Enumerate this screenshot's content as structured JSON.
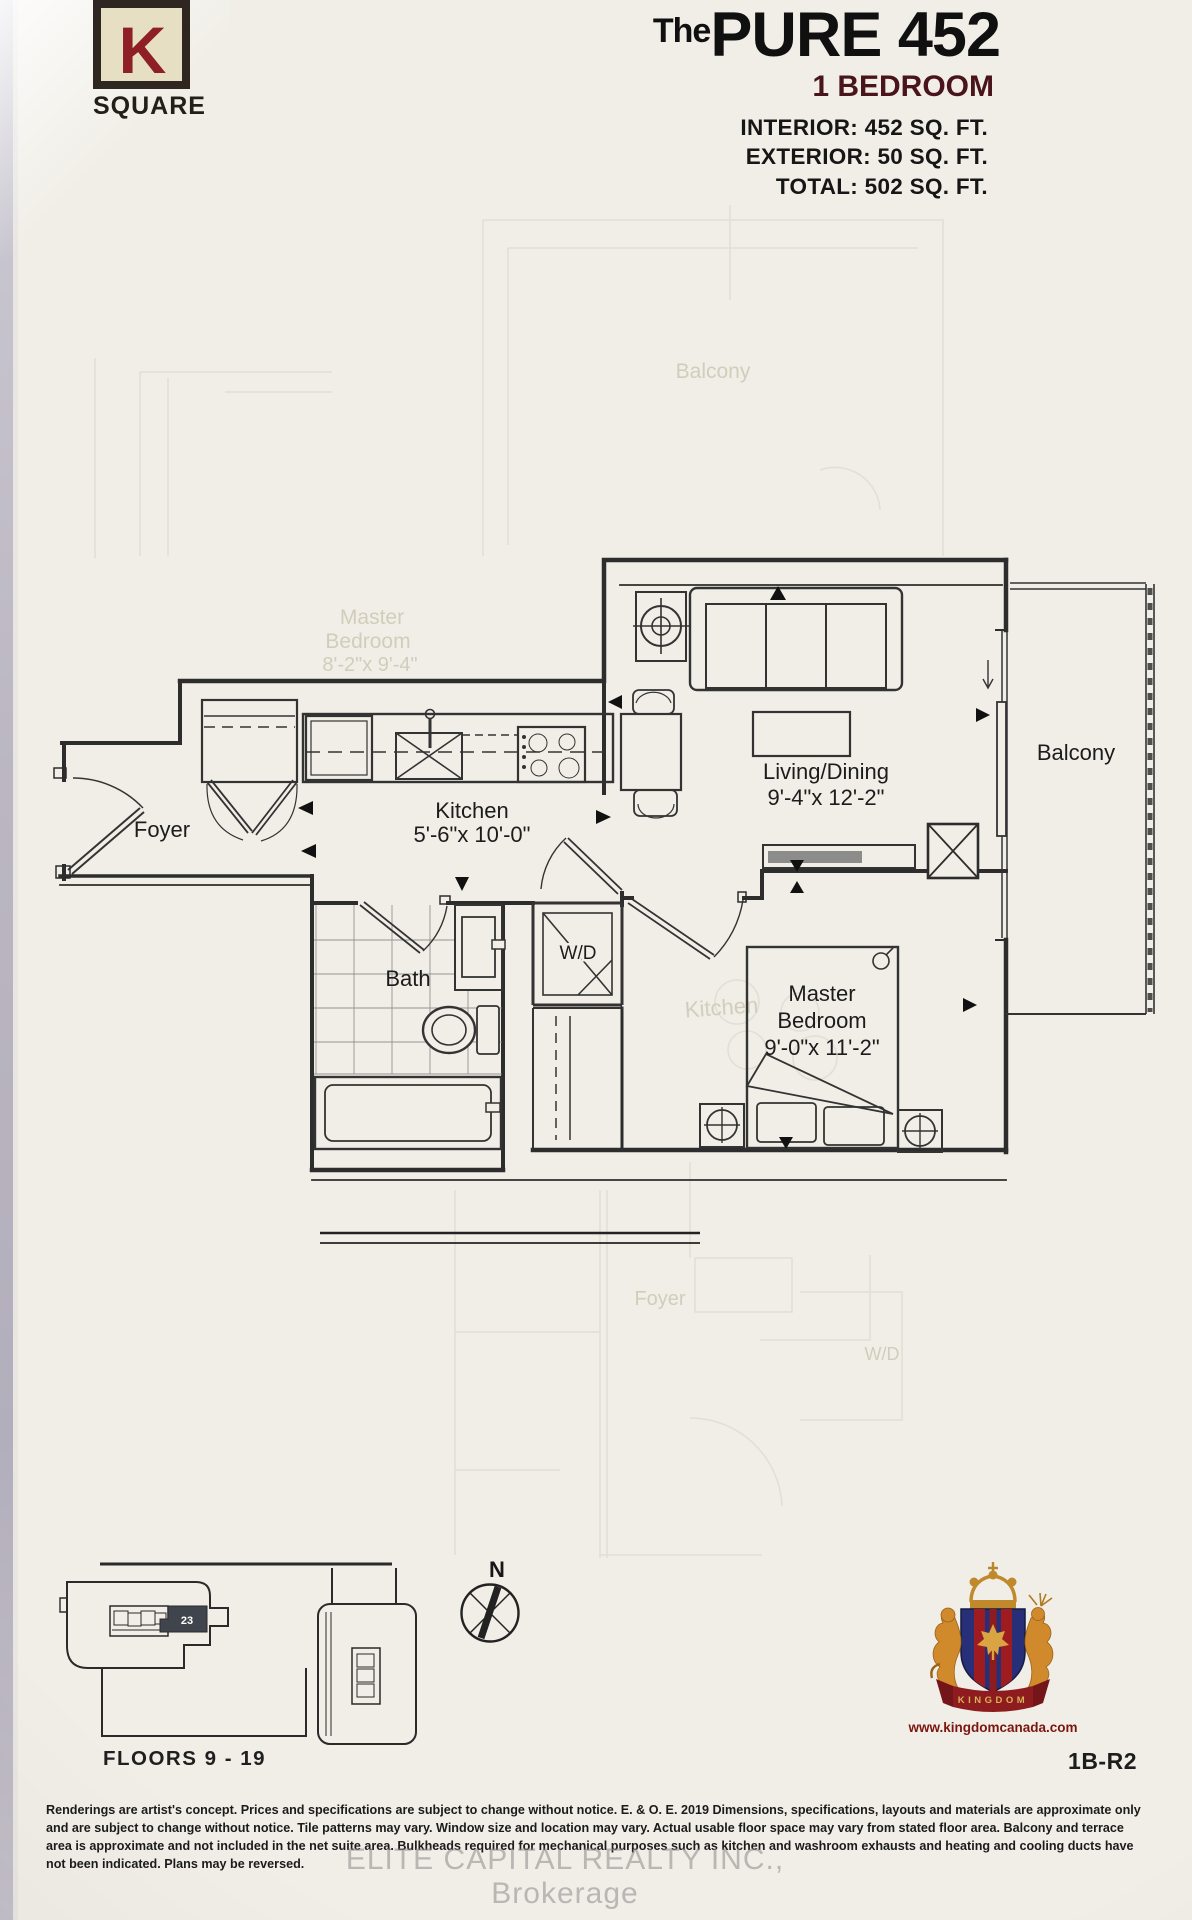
{
  "branding": {
    "logo_letter": "K",
    "logo_word": "SQUARE"
  },
  "header": {
    "title_prefix": "The",
    "title_main": "PURE 452",
    "plan_type": "1 BEDROOM",
    "area_lines": [
      "INTERIOR: 452 SQ. FT.",
      "EXTERIOR: 50 SQ. FT.",
      "TOTAL: 502 SQ. FT."
    ]
  },
  "floorplan": {
    "rooms": [
      {
        "name": "Foyer",
        "dims": ""
      },
      {
        "name": "Kitchen",
        "dims": "5'-6\"x 10'-0\""
      },
      {
        "name": "Living/Dining",
        "dims": "9'-4\"x 12'-2\""
      },
      {
        "name": "Balcony",
        "dims": ""
      },
      {
        "name": "Bath",
        "dims": ""
      },
      {
        "name": "W/D",
        "dims": ""
      },
      {
        "name": "Master",
        "name2": "Bedroom",
        "dims": "9'-0\"x 11'-2\""
      }
    ],
    "ghost_labels": {
      "balcony": "Balcony",
      "master1": "Master",
      "master2": "Bedroom",
      "master_dims": "8'-2\"x 9'-4\"",
      "kitchen": "Kitchen",
      "foyer": "Foyer",
      "wd": "W/D"
    }
  },
  "keyplan": {
    "floors_label": "FLOORS 9 - 19",
    "unit_number": "23",
    "north_label": "N"
  },
  "crest": {
    "banner": "KINGDOM",
    "website": "www.kingdomcanada.com"
  },
  "footer": {
    "plan_code": "1B-R2",
    "disclaimer_lines": [
      "Renderings are artist's concept. Prices and specifications are subject to change without notice. E. & O. E. 2019 Dimensions, specifications, layouts and materials are approximate only",
      "and are subject to change without notice. Tile patterns may vary. Window size and location may vary. Actual usable floor space may vary from stated floor area. Balcony and terrace",
      "area is approximate and not included in the net suite area. Bulkheads required for mechanical purposes such as kitchen and washroom exhausts and heating and cooling ducts have",
      "not been indicated. Plans may be reversed."
    ],
    "watermark": "ELITE CAPITAL REALTY INC., Brokerage"
  }
}
